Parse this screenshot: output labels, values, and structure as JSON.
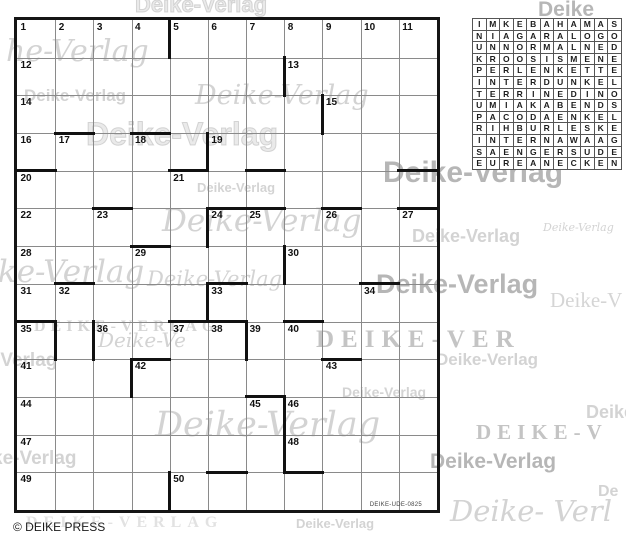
{
  "meta": {
    "copyright": "© DEIKE PRESS",
    "ref_code": "DEIKE-UDE-0825"
  },
  "colors": {
    "thin_line": "#8a8a8a",
    "thick_line": "#111111",
    "number_color": "#111111",
    "watermark_grey": "#a8a8a8",
    "background": "#ffffff"
  },
  "puzzle": {
    "cols": 11,
    "rows": 13,
    "cell_w": 38.18,
    "cell_h": 37.69,
    "numbers": [
      {
        "n": 1,
        "r": 1,
        "c": 1
      },
      {
        "n": 2,
        "r": 1,
        "c": 2
      },
      {
        "n": 3,
        "r": 1,
        "c": 3
      },
      {
        "n": 4,
        "r": 1,
        "c": 4
      },
      {
        "n": 5,
        "r": 1,
        "c": 5
      },
      {
        "n": 6,
        "r": 1,
        "c": 6
      },
      {
        "n": 7,
        "r": 1,
        "c": 7
      },
      {
        "n": 8,
        "r": 1,
        "c": 8
      },
      {
        "n": 9,
        "r": 1,
        "c": 9
      },
      {
        "n": 10,
        "r": 1,
        "c": 10
      },
      {
        "n": 11,
        "r": 1,
        "c": 11
      },
      {
        "n": 12,
        "r": 2,
        "c": 1
      },
      {
        "n": 13,
        "r": 2,
        "c": 8
      },
      {
        "n": 14,
        "r": 3,
        "c": 1
      },
      {
        "n": 15,
        "r": 3,
        "c": 9
      },
      {
        "n": 16,
        "r": 4,
        "c": 1
      },
      {
        "n": 17,
        "r": 4,
        "c": 2
      },
      {
        "n": 18,
        "r": 4,
        "c": 4
      },
      {
        "n": 19,
        "r": 4,
        "c": 6
      },
      {
        "n": 20,
        "r": 5,
        "c": 1
      },
      {
        "n": 21,
        "r": 5,
        "c": 5
      },
      {
        "n": 22,
        "r": 6,
        "c": 1
      },
      {
        "n": 23,
        "r": 6,
        "c": 3
      },
      {
        "n": 24,
        "r": 6,
        "c": 6
      },
      {
        "n": 25,
        "r": 6,
        "c": 7
      },
      {
        "n": 26,
        "r": 6,
        "c": 9
      },
      {
        "n": 27,
        "r": 6,
        "c": 11
      },
      {
        "n": 28,
        "r": 7,
        "c": 1
      },
      {
        "n": 29,
        "r": 7,
        "c": 4
      },
      {
        "n": 30,
        "r": 7,
        "c": 8
      },
      {
        "n": 31,
        "r": 8,
        "c": 1
      },
      {
        "n": 32,
        "r": 8,
        "c": 2
      },
      {
        "n": 33,
        "r": 8,
        "c": 6
      },
      {
        "n": 34,
        "r": 8,
        "c": 10
      },
      {
        "n": 35,
        "r": 9,
        "c": 1
      },
      {
        "n": 36,
        "r": 9,
        "c": 3
      },
      {
        "n": 37,
        "r": 9,
        "c": 5
      },
      {
        "n": 38,
        "r": 9,
        "c": 6
      },
      {
        "n": 39,
        "r": 9,
        "c": 7
      },
      {
        "n": 40,
        "r": 9,
        "c": 8
      },
      {
        "n": 41,
        "r": 10,
        "c": 1
      },
      {
        "n": 42,
        "r": 10,
        "c": 4
      },
      {
        "n": 43,
        "r": 10,
        "c": 9
      },
      {
        "n": 44,
        "r": 11,
        "c": 1
      },
      {
        "n": 45,
        "r": 11,
        "c": 7
      },
      {
        "n": 46,
        "r": 11,
        "c": 8
      },
      {
        "n": 47,
        "r": 12,
        "c": 1
      },
      {
        "n": 48,
        "r": 12,
        "c": 8
      },
      {
        "n": 49,
        "r": 13,
        "c": 1
      },
      {
        "n": 50,
        "r": 13,
        "c": 5
      }
    ],
    "thick_vertical_right_of": [
      {
        "r": 1,
        "c": 4
      },
      {
        "r": 2,
        "c": 7
      },
      {
        "r": 3,
        "c": 8
      },
      {
        "r": 4,
        "c": 5
      },
      {
        "r": 6,
        "c": 5
      },
      {
        "r": 7,
        "c": 7
      },
      {
        "r": 8,
        "c": 5
      },
      {
        "r": 9,
        "c": 1
      },
      {
        "r": 9,
        "c": 2
      },
      {
        "r": 9,
        "c": 6
      },
      {
        "r": 10,
        "c": 3
      },
      {
        "r": 11,
        "c": 7
      },
      {
        "r": 12,
        "c": 7
      },
      {
        "r": 13,
        "c": 4
      }
    ],
    "thick_horizontal_top_of": [
      {
        "r": 4,
        "c": 2
      },
      {
        "r": 4,
        "c": 4
      },
      {
        "r": 5,
        "c": 1
      },
      {
        "r": 5,
        "c": 5
      },
      {
        "r": 5,
        "c": 7
      },
      {
        "r": 5,
        "c": 11
      },
      {
        "r": 6,
        "c": 3
      },
      {
        "r": 6,
        "c": 6
      },
      {
        "r": 6,
        "c": 7
      },
      {
        "r": 6,
        "c": 9
      },
      {
        "r": 6,
        "c": 11
      },
      {
        "r": 7,
        "c": 4
      },
      {
        "r": 8,
        "c": 2
      },
      {
        "r": 8,
        "c": 6
      },
      {
        "r": 8,
        "c": 10
      },
      {
        "r": 9,
        "c": 1
      },
      {
        "r": 9,
        "c": 5
      },
      {
        "r": 9,
        "c": 6
      },
      {
        "r": 9,
        "c": 8
      },
      {
        "r": 10,
        "c": 4
      },
      {
        "r": 10,
        "c": 9
      },
      {
        "r": 11,
        "c": 7
      },
      {
        "r": 13,
        "c": 6
      },
      {
        "r": 13,
        "c": 8
      }
    ]
  },
  "solution": {
    "rows": [
      "IMKEBAHAMAS",
      "NIAGARALOGO",
      "UNNORMALNED",
      "KROOSISMENE",
      "PERLENKETTE",
      "INTERDUNKEL",
      "TERRINEDINO",
      "UMIAKABENDS",
      "PACODAENKEL",
      "RIHBURLESKE",
      "INTERNAWAAG",
      "SAENGERSUDE",
      "EUREANECKEN"
    ]
  },
  "watermarks": [
    {
      "cls": "wm-outline",
      "text": "Deike-Verlag",
      "x": 135,
      "y": -8,
      "size": 22
    },
    {
      "cls": "wm-bold-dark",
      "text": "Deike",
      "x": 538,
      "y": -2,
      "size": 21
    },
    {
      "cls": "wm-script",
      "text": "he-Verlag",
      "x": 6,
      "y": 34,
      "size": 30
    },
    {
      "cls": "wm-bold",
      "text": "Deike-Verlag",
      "x": 24,
      "y": 86,
      "size": 17
    },
    {
      "cls": "wm-script",
      "text": "Deike-Verlag",
      "x": 195,
      "y": 80,
      "size": 27
    },
    {
      "cls": "wm-outline",
      "text": "Deike-Verlag",
      "x": 86,
      "y": 116,
      "size": 32
    },
    {
      "cls": "wm-bold-dark",
      "text": "Deike-Verlag",
      "x": 383,
      "y": 156,
      "size": 30
    },
    {
      "cls": "wm-bold",
      "text": "Deike-Verlag",
      "x": 197,
      "y": 180,
      "size": 13
    },
    {
      "cls": "wm-script",
      "text": "Deike-Verlag",
      "x": 162,
      "y": 203,
      "size": 31
    },
    {
      "cls": "wm-bold",
      "text": "Deike-Verlag",
      "x": 412,
      "y": 226,
      "size": 18
    },
    {
      "cls": "wm-script",
      "text": "Deike-Verlag",
      "x": 543,
      "y": 221,
      "size": 11
    },
    {
      "cls": "wm-script",
      "text": "ike-Verlag",
      "x": -12,
      "y": 254,
      "size": 31
    },
    {
      "cls": "wm-script",
      "text": "Deike-Verlag",
      "x": 147,
      "y": 267,
      "size": 21
    },
    {
      "cls": "wm-bold-dark",
      "text": "Deike-Verlag",
      "x": 376,
      "y": 269,
      "size": 27
    },
    {
      "cls": "wm-serif",
      "text": "Deike-V",
      "x": 550,
      "y": 288,
      "size": 21
    },
    {
      "cls": "wm-caps",
      "text": "DEIKE-VERLAG",
      "x": 34,
      "y": 318,
      "size": 16,
      "ls": 5
    },
    {
      "cls": "wm-script",
      "text": "Deike-Ve",
      "x": 98,
      "y": 328,
      "size": 20
    },
    {
      "cls": "wm-caps-big",
      "text": "DEIKE-VER",
      "x": 316,
      "y": 326,
      "size": 25,
      "ls": 7
    },
    {
      "cls": "wm-bold",
      "text": "-Verlag",
      "x": -6,
      "y": 350,
      "size": 19
    },
    {
      "cls": "wm-bold",
      "text": "Deike-Verlag",
      "x": 436,
      "y": 350,
      "size": 17
    },
    {
      "cls": "wm-bold",
      "text": "Deike-Verlag",
      "x": 342,
      "y": 384,
      "size": 14
    },
    {
      "cls": "wm-script",
      "text": "Deike-Verlag",
      "x": 155,
      "y": 405,
      "size": 35
    },
    {
      "cls": "wm-caps-big",
      "text": "DEIKE-V",
      "x": 476,
      "y": 420,
      "size": 21,
      "ls": 6
    },
    {
      "cls": "wm-bold",
      "text": "Deike",
      "x": 586,
      "y": 402,
      "size": 18
    },
    {
      "cls": "wm-bold",
      "text": "ke-Verlag",
      "x": -8,
      "y": 448,
      "size": 19
    },
    {
      "cls": "wm-bold-dark",
      "text": "Deike-Verlag",
      "x": 430,
      "y": 450,
      "size": 21
    },
    {
      "cls": "wm-bold",
      "text": "De",
      "x": 598,
      "y": 483,
      "size": 16
    },
    {
      "cls": "wm-caps-light",
      "text": "DEIKE-VERLAG",
      "x": 26,
      "y": 514,
      "size": 16,
      "ls": 6
    },
    {
      "cls": "wm-bold",
      "text": "Deike-Verlag",
      "x": 296,
      "y": 516,
      "size": 13
    },
    {
      "cls": "wm-script",
      "text": "Deike- Verl",
      "x": 450,
      "y": 494,
      "size": 29
    }
  ]
}
